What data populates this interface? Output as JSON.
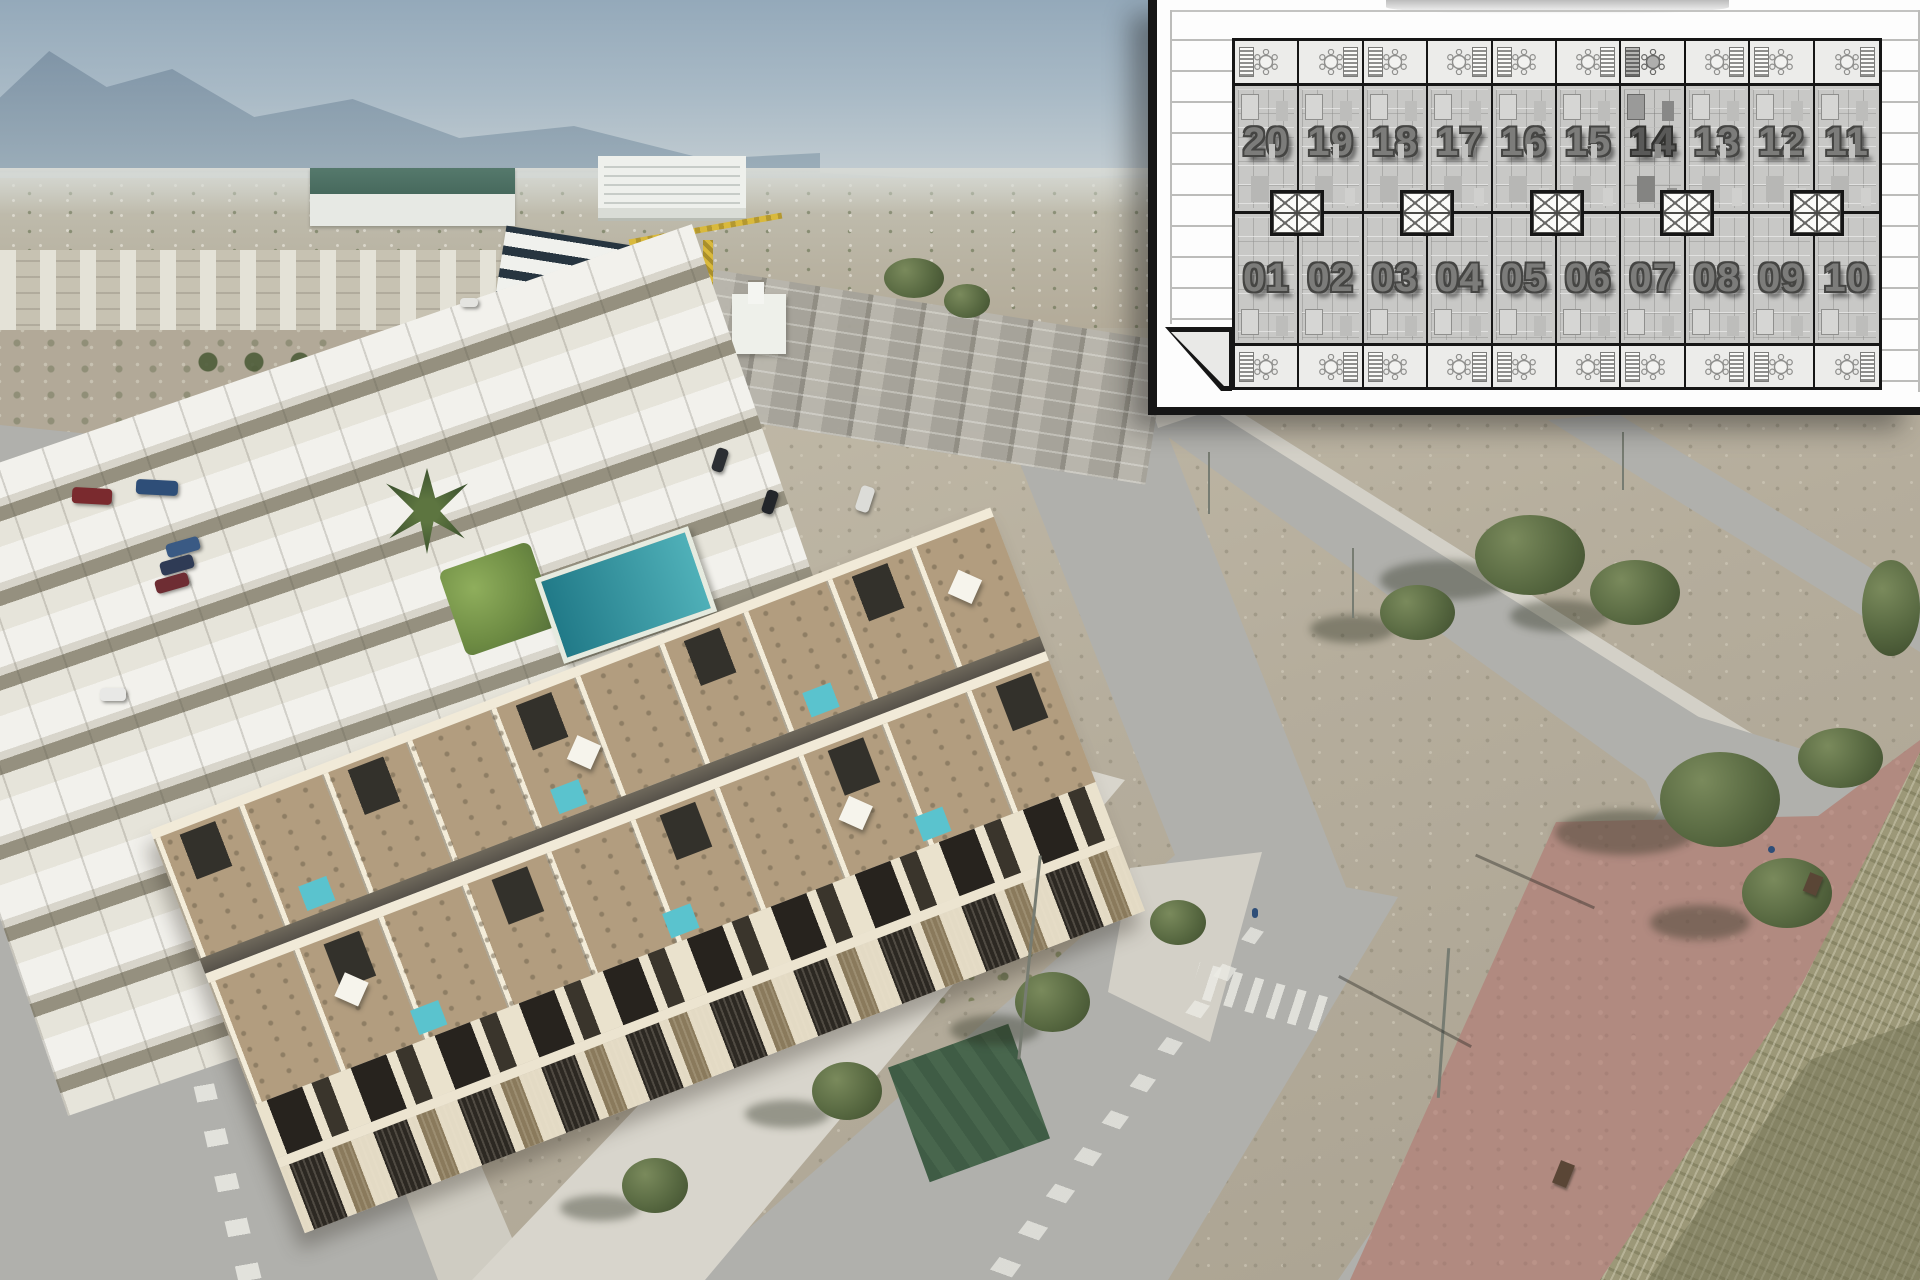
{
  "image": {
    "kind": "Real-estate aerial render with site-plan inset",
    "description": "Aerial drone view of a new-build two-storey townhouse block with rooftop terraces, pergolas and plunge pools, next to an existing white townhouse complex with a communal pool, vacant dirt plots, streets, trees and a red pedestrian promenade; a white architectural site plan framed in black overlays the top-right corner showing 20 numbered units in two rows of ten."
  },
  "inset_plan": {
    "row_top": {
      "units": [
        "20",
        "19",
        "18",
        "17",
        "16",
        "15",
        "14",
        "13",
        "12",
        "11"
      ]
    },
    "row_bottom": {
      "units": [
        "01",
        "02",
        "03",
        "04",
        "05",
        "06",
        "07",
        "08",
        "09",
        "10"
      ]
    },
    "highlighted_unit": "14",
    "shaft_count": "5",
    "icons": {
      "terrace_table": "round-table-with-six-chairs-icon",
      "stairs": "staircase-icon",
      "shaft": "crossed-elevator-shaft-icon"
    },
    "colors": {
      "sheet": "#fdfdfd",
      "frame": "#161616",
      "terrace_fill": "#ececea",
      "unit_fill": "#c8c8c6",
      "number_fill": "#7c7c7a",
      "number_outline": "#454543"
    }
  },
  "photo": {
    "elements": [
      "hazy sky",
      "mountain ridge",
      "distant plain with scattered houses",
      "white town buildings",
      "green-roofed warehouse",
      "white office building",
      "tower crane",
      "townhouses under construction",
      "concrete frames with scaffolding",
      "existing white townhouse complex",
      "communal swimming pool",
      "garden hedge",
      "palm tree",
      "new townhouse block with rooftop terraces and plunge pools",
      "streets with lane markings and crosswalks",
      "parked cars",
      "vacant dirt plots with scrub",
      "street trees and lampposts",
      "corner lawn",
      "red pedestrian promenade with benches",
      "dry grass riverbank"
    ],
    "colors": {
      "sky_top": "#94a9ba",
      "dirt": "#b5ad9c",
      "road": "#b0b0ac",
      "promenade": "#b18a80",
      "riverbank_grass": "#9c9878",
      "building_cream": "#ece4d0",
      "communal_pool": "#217a88",
      "plunge_pool": "#5ac3ce",
      "pergola": "#33312b",
      "tree": "#55663f",
      "crane": "#d9b93c"
    }
  }
}
